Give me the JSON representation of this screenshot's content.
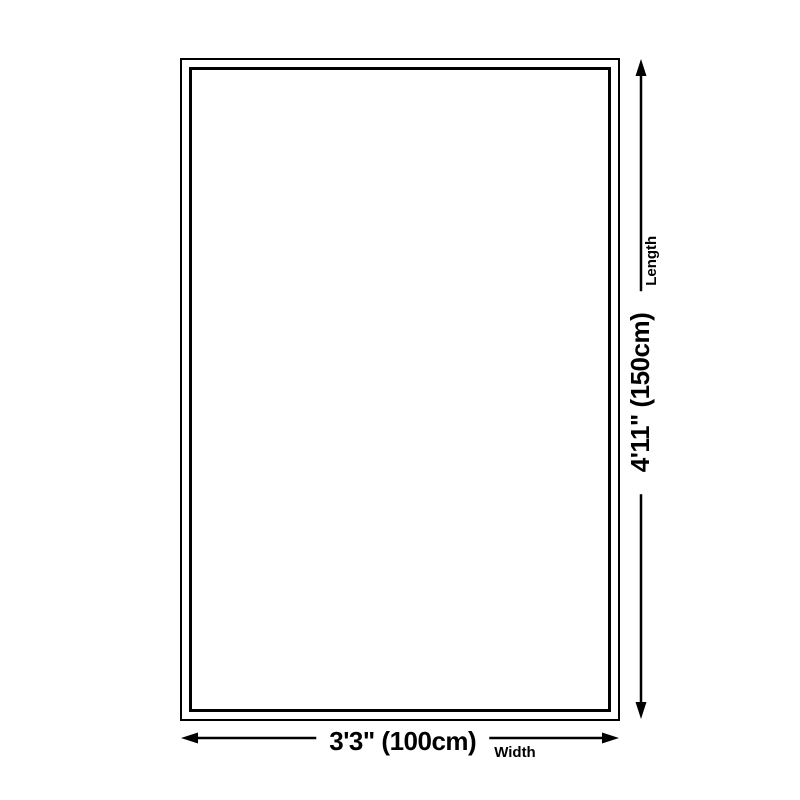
{
  "diagram": {
    "name": "rug-dimension-diagram",
    "background_color": "#ffffff",
    "line_color": "#000000",
    "shape": "rectangle",
    "length": {
      "value": "4'11\" (150cm)",
      "label": "Length"
    },
    "width": {
      "value": "3'3\" (100cm)",
      "label": "Width"
    }
  }
}
